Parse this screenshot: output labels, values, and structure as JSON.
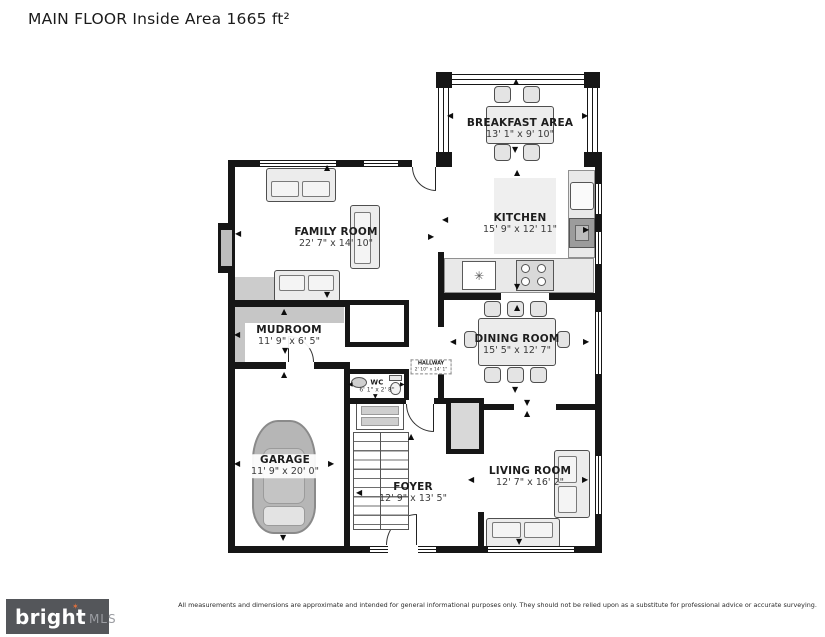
{
  "title": "MAIN FLOOR Inside Area 1665 ft²",
  "rooms": {
    "breakfast": {
      "name": "BREAKFAST AREA",
      "dims": "13' 1\" x 9' 10\""
    },
    "kitchen": {
      "name": "KITCHEN",
      "dims": "15' 9\" x 12' 11\""
    },
    "family": {
      "name": "FAMILY ROOM",
      "dims": "22' 7\" x 14' 10\""
    },
    "mudroom": {
      "name": "MUDROOM",
      "dims": "11' 9\" x 6' 5\""
    },
    "wc": {
      "name": "WC",
      "dims": "6' 1\" x 2' 8\""
    },
    "hallway": {
      "name": "HALLWAY",
      "dims": "2' 10\" x 14' 1\""
    },
    "dining": {
      "name": "DINING ROOM",
      "dims": "15' 5\" x 12' 7\""
    },
    "garage": {
      "name": "GARAGE",
      "dims": "11' 9\" x 20' 0\""
    },
    "foyer": {
      "name": "FOYER",
      "dims": "12' 9\" x 13' 5\""
    },
    "living": {
      "name": "LIVING ROOM",
      "dims": "12' 7\" x 16' 2\""
    }
  },
  "icons": {
    "arrow_up": "▲",
    "arrow_down": "▼",
    "arrow_left": "◀",
    "arrow_right": "▶",
    "sink": "✳",
    "logo_star": "✶"
  },
  "footer": {
    "disclaimer": "All measurements and dimensions are approximate and intended for general informational purposes only. They should not be relied upon as a substitute for professional advice or accurate surveying."
  },
  "logo": {
    "brand": "bright",
    "suffix": "MLS"
  },
  "colors": {
    "wall": "#161616",
    "accent_star": "#e4703c",
    "logo_bg": "#54565a"
  }
}
